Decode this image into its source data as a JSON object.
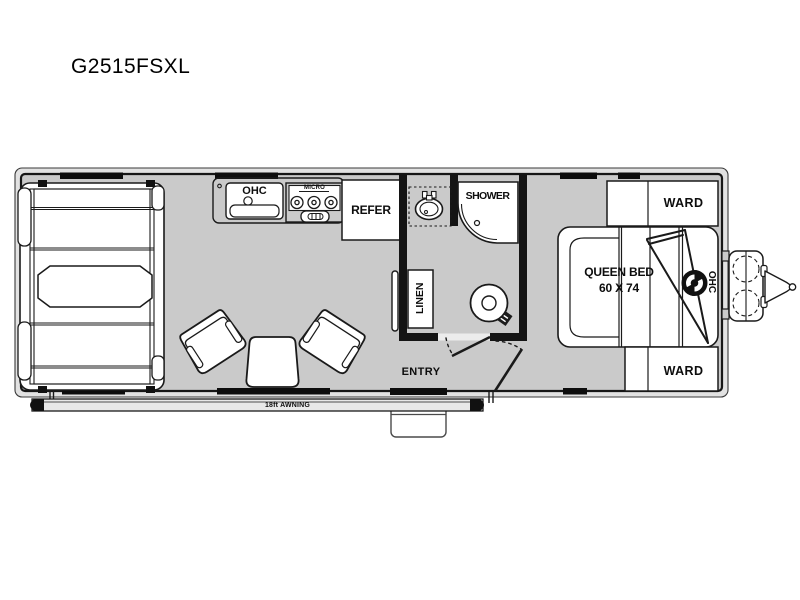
{
  "title": "G2515FSXL",
  "floorplan": {
    "colors": {
      "floor": "#cacaca",
      "wall": "#141414",
      "body_band": "#e2e2e2",
      "fixture_fill": "#ffffff",
      "awning_fill": "#e9e9e9"
    },
    "labels": {
      "kitchen_ohc": "OHC",
      "micro": "MICRO",
      "refer": "REFER",
      "shower": "SHOWER",
      "linen": "LINEN",
      "queen_bed_line1": "QUEEN BED",
      "queen_bed_line2": "60 X 74",
      "ward_top": "WARD",
      "ward_bottom": "WARD",
      "bedroom_ohc": "OHC",
      "entry": "ENTRY",
      "awning": "18ft AWNING"
    }
  }
}
